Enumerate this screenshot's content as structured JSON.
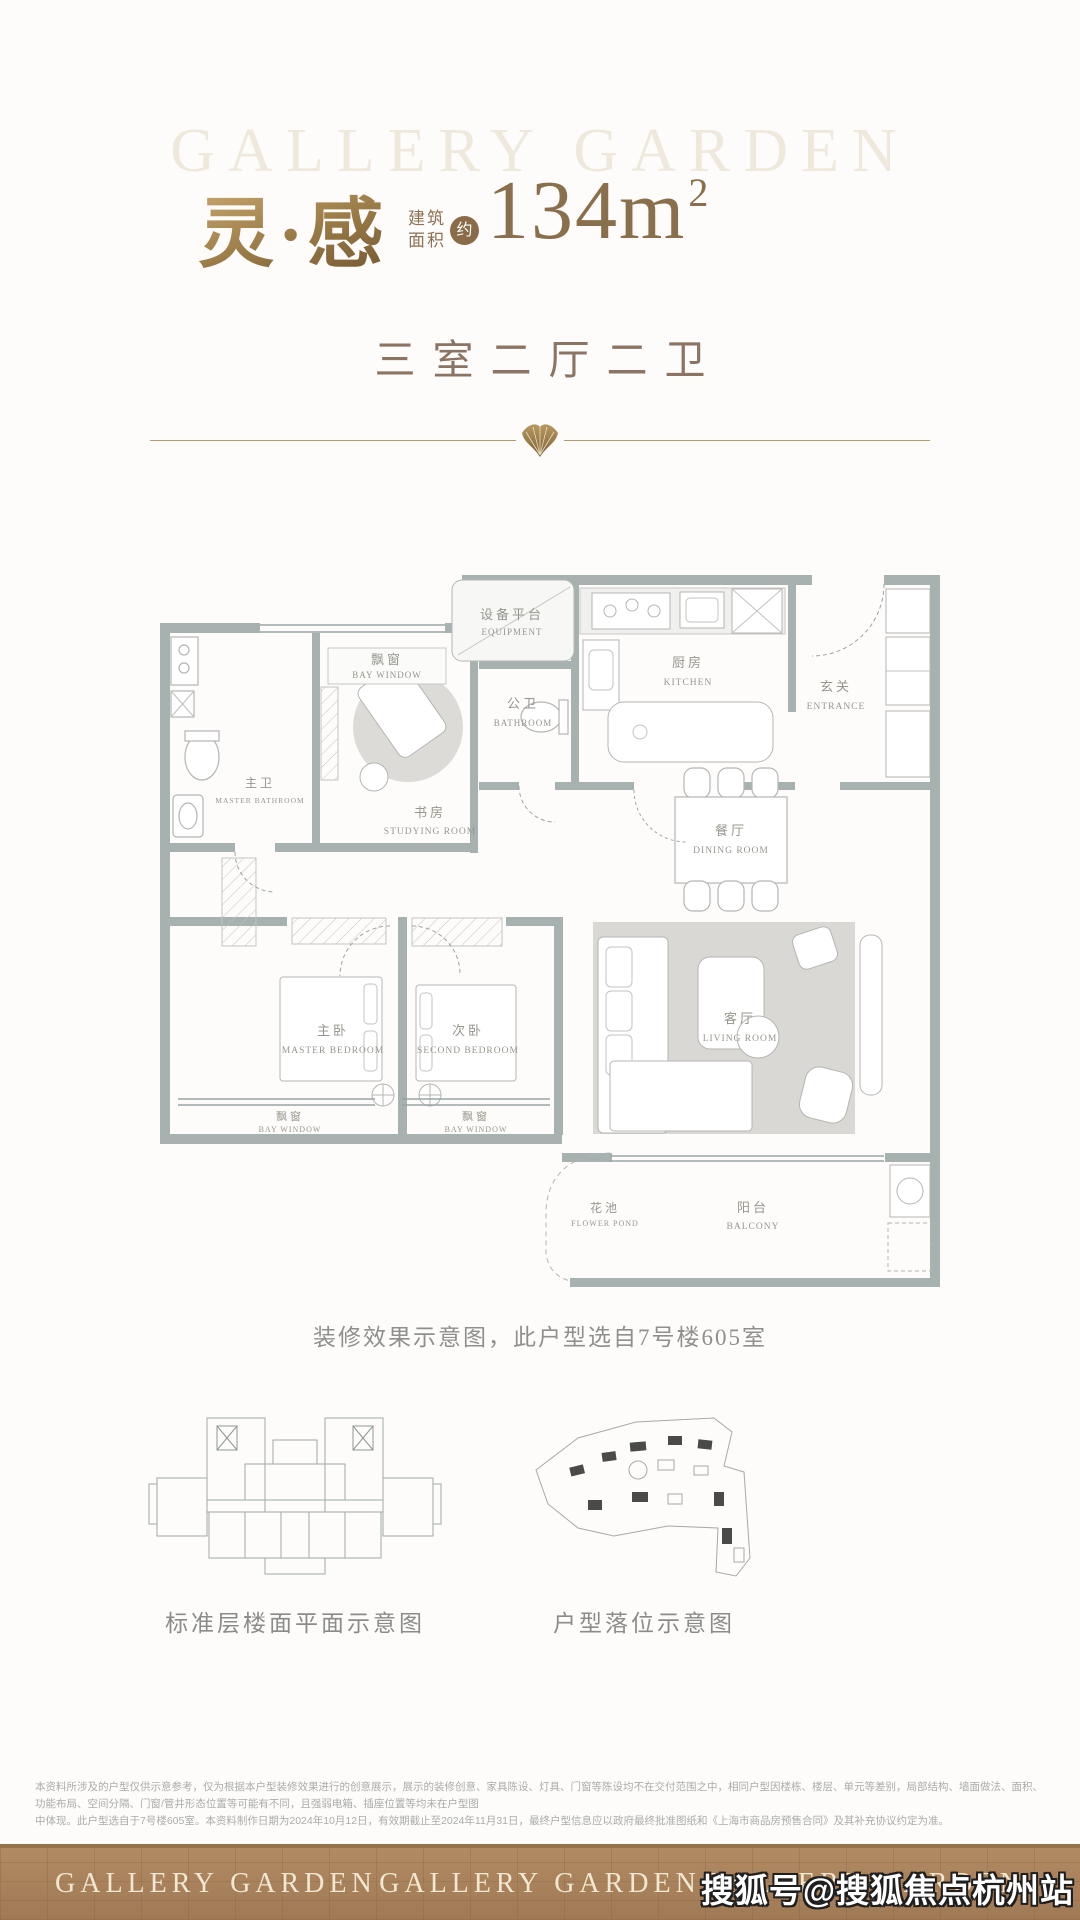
{
  "header": {
    "watermark": "GALLERY GARDEN",
    "title": "灵·感",
    "area_label_line1": "建筑",
    "area_label_line2": "面积",
    "area_badge": "约",
    "area_value": "134m",
    "area_sup": "2",
    "subtitle": "三室二厅二卫"
  },
  "plan": {
    "caption": "装修效果示意图，此户型选自7号楼605室",
    "rooms": {
      "bay_top": {
        "cn": "飘窗",
        "en": "BAY WINDOW"
      },
      "equipment": {
        "cn": "设备平台",
        "en": "EQUIPMENT"
      },
      "public_bath": {
        "cn": "公卫",
        "en": "BATHROOM"
      },
      "kitchen": {
        "cn": "厨房",
        "en": "KITCHEN"
      },
      "entrance": {
        "cn": "玄关",
        "en": "ENTRANCE"
      },
      "master_bath": {
        "cn": "主卫",
        "en": "MASTER BATHROOM"
      },
      "study": {
        "cn": "书房",
        "en": "STUDYING ROOM"
      },
      "dining": {
        "cn": "餐厅",
        "en": "DINING ROOM"
      },
      "master_bed": {
        "cn": "主卧",
        "en": "MASTER BEDROOM"
      },
      "second_bed": {
        "cn": "次卧",
        "en": "SECOND BEDROOM"
      },
      "living": {
        "cn": "客厅",
        "en": "LIVING ROOM"
      },
      "bay_left": {
        "cn": "飘窗",
        "en": "BAY WINDOW"
      },
      "bay_right": {
        "cn": "飘窗",
        "en": "BAY WINDOW"
      },
      "flower_pond": {
        "cn": "花池",
        "en": "FLOWER POND"
      },
      "balcony": {
        "cn": "阳台",
        "en": "BALCONY"
      }
    }
  },
  "diagrams": {
    "floor_label": "标准层楼面平面示意图",
    "location_label": "户型落位示意图"
  },
  "disclaimer": {
    "line1": "本资料所涉及的户型仅供示意参考，仅为根据本户型装修效果进行的创意展示，展示的装修创意、家具陈设、灯具、门窗等陈设均不在交付范围之中，相同户型因楼栋、楼层、单元等差别，局部结构、墙面做法、面积、功能布局、空间分隔、门窗/管井形态位置等可能有不同，且强弱电箱、插座位置等均未在户型图",
    "line2": "中体现。此户型选自于7号楼605室。本资料制作日期为2024年10月12日，有效期截止至2024年11月31日，最终户型信息应以政府最终批准图纸和《上海市商品房预售合同》及其补充协议约定为准。"
  },
  "footer": {
    "brand": "GALLERY GARDEN"
  },
  "overlay": {
    "sohu_watermark": "搜狐号@搜狐焦点杭州站"
  },
  "colors": {
    "gold": "#a5854f",
    "title_brown": "#8a6f4c",
    "subtitle_brown": "#8b7463",
    "wall_gray": "#a7b2b0",
    "carpet_gray": "#d9d8d4",
    "footer_brown": "#a9825e"
  }
}
